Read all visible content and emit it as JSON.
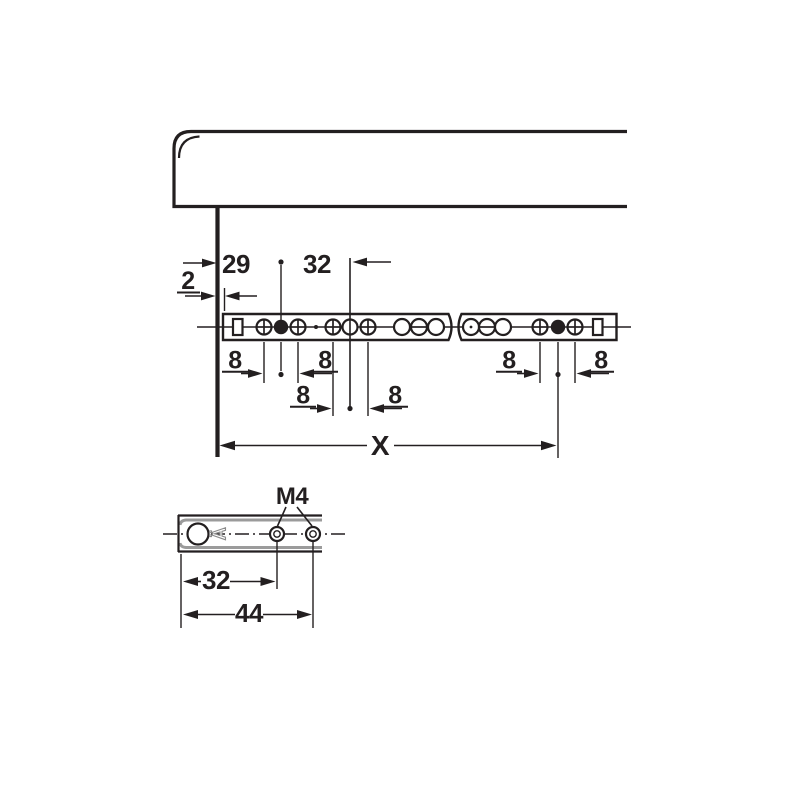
{
  "colors": {
    "line": "#231f20",
    "background": "#ffffff",
    "metal_gray": "#9b9b9b"
  },
  "top_view": {
    "dim_panel_gap": "2",
    "dim_front_offset": "29",
    "dim_hole_pitch_32": "32",
    "dim_pitch_8": "8",
    "dim_length": "X"
  },
  "detail_view": {
    "thread_label": "M4",
    "dim_hole1": "32",
    "dim_hole2": "44",
    "stamp_mark": "Ä"
  }
}
